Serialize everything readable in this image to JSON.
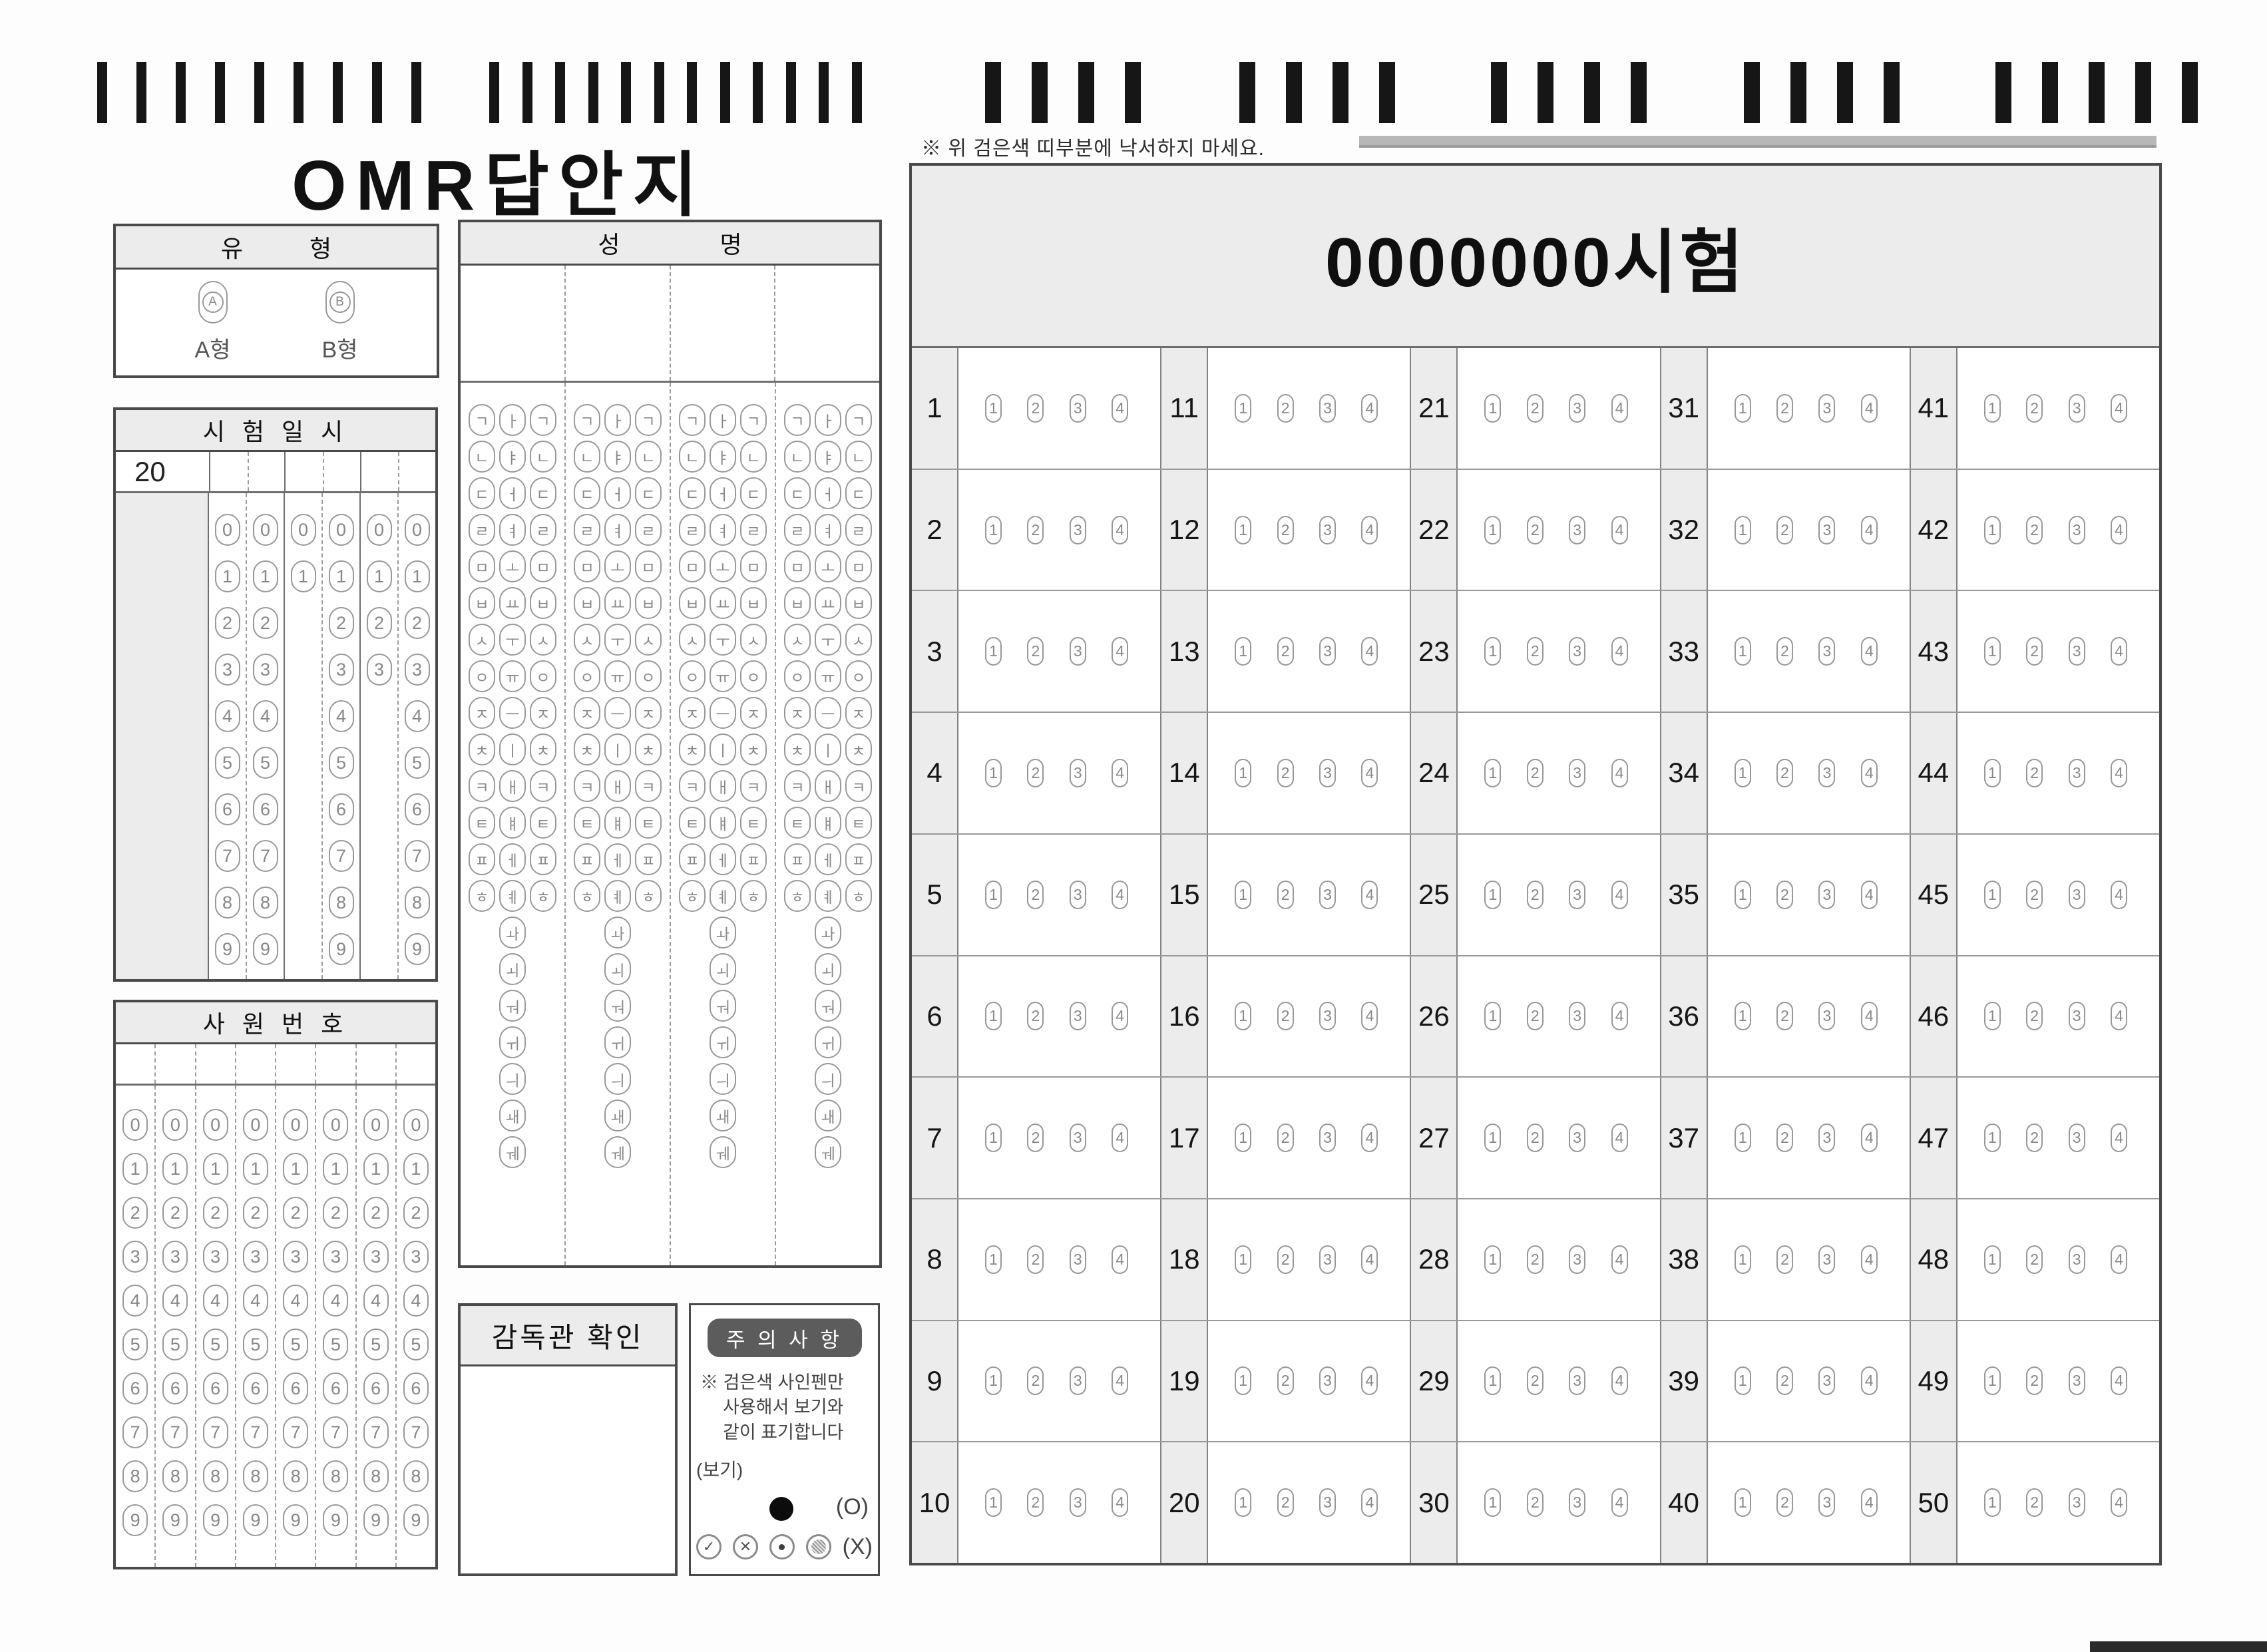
{
  "title": "OMR답안지",
  "top_note": "※ 위 검은색 띠부분에 낙서하지 마세요.",
  "timing_marks": {
    "groups": [
      9,
      12,
      4,
      4,
      4,
      4,
      5
    ]
  },
  "type_box": {
    "header": "유 형",
    "options": [
      {
        "bubble": "A",
        "label": "A형"
      },
      {
        "bubble": "B",
        "label": "B형"
      }
    ]
  },
  "exam_datetime_box": {
    "header": "시 험 일 시",
    "year_prefix": "20",
    "columns": [
      {
        "name": "year-tens",
        "digits": [
          "0",
          "1",
          "2",
          "3",
          "4",
          "5",
          "6",
          "7",
          "8",
          "9"
        ]
      },
      {
        "name": "year-ones",
        "digits": [
          "0",
          "1",
          "2",
          "3",
          "4",
          "5",
          "6",
          "7",
          "8",
          "9"
        ]
      },
      {
        "name": "month-tens",
        "digits": [
          "0",
          "1"
        ]
      },
      {
        "name": "month-ones",
        "digits": [
          "0",
          "1",
          "2",
          "3",
          "4",
          "5",
          "6",
          "7",
          "8",
          "9"
        ]
      },
      {
        "name": "day-tens",
        "digits": [
          "0",
          "1",
          "2",
          "3"
        ]
      },
      {
        "name": "day-ones",
        "digits": [
          "0",
          "1",
          "2",
          "3",
          "4",
          "5",
          "6",
          "7",
          "8",
          "9"
        ]
      }
    ]
  },
  "employee_no_box": {
    "header": "사 원 번 호",
    "columns": 8,
    "digits": [
      "0",
      "1",
      "2",
      "3",
      "4",
      "5",
      "6",
      "7",
      "8",
      "9"
    ]
  },
  "name_box": {
    "header": "성 명",
    "columns": 4,
    "consonants": [
      "ㄱ",
      "ㄴ",
      "ㄷ",
      "ㄹ",
      "ㅁ",
      "ㅂ",
      "ㅅ",
      "ㅇ",
      "ㅈ",
      "ㅊ",
      "ㅋ",
      "ㅌ",
      "ㅍ",
      "ㅎ"
    ],
    "vowels": [
      "ㅏ",
      "ㅑ",
      "ㅓ",
      "ㅕ",
      "ㅗ",
      "ㅛ",
      "ㅜ",
      "ㅠ",
      "ㅡ",
      "ㅣ",
      "ㅐ",
      "ㅒ",
      "ㅔ",
      "ㅖ"
    ],
    "compound_vowels": [
      "ㅘ",
      "ㅚ",
      "ㅝ",
      "ㅟ",
      "ㅢ",
      "ㅙ",
      "ㅞ"
    ]
  },
  "supervisor_box": {
    "header": "감독관 확인"
  },
  "caution_box": {
    "badge": "주 의 사 항",
    "lines": [
      "※ 검은색 사인펜만",
      "사용해서 보기와",
      "같이 표기합니다"
    ],
    "example_label": "(보기)",
    "correct_label": "(O)",
    "wrong_label": "(X)",
    "wrong_marks": [
      "check",
      "x",
      "dot",
      "partial"
    ]
  },
  "answer_grid": {
    "title": "0000000시험",
    "group_starts": [
      1,
      11,
      21,
      31,
      41
    ],
    "rows_per_group": 10,
    "choices": [
      "1",
      "2",
      "3",
      "4"
    ]
  },
  "colors": {
    "paper": "#fdfdfd",
    "shade": "#ececec",
    "border": "#4a4a4a",
    "bubble": "#999999",
    "bubtext": "#888888",
    "mark": "#161616",
    "badge": "#5c5c5c",
    "badgetext": "#ffffff"
  }
}
